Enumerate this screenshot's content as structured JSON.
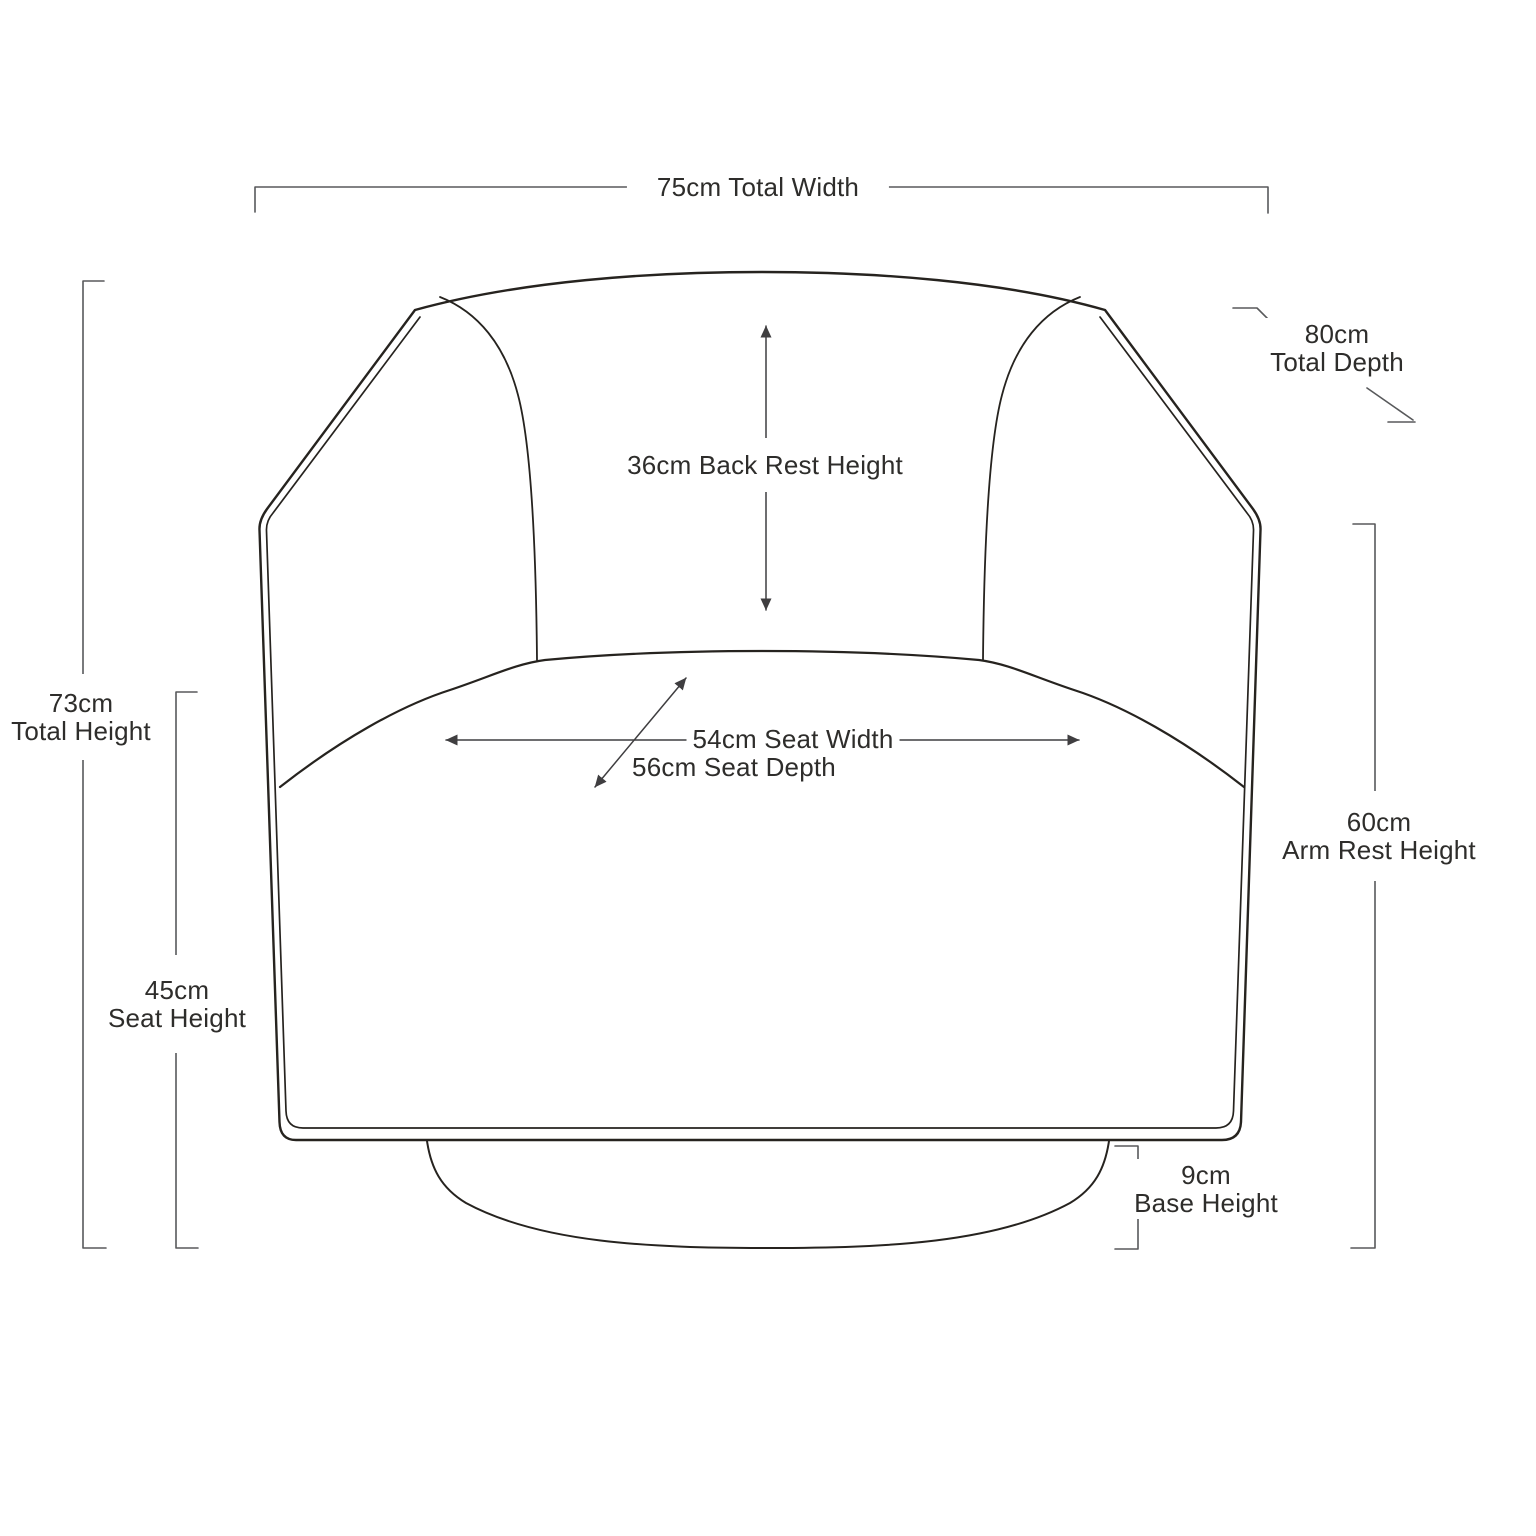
{
  "page": {
    "type": "product-dimension-diagram",
    "subject": "swivel armchair, front elevation line drawing",
    "background": "#ffffff"
  },
  "colors": {
    "chair_outline": "#26231f",
    "dimension_line": "#58595b",
    "arrow_line": "#3f3e40",
    "label_text": "#2e2d2b"
  },
  "dimensions": {
    "total_width": {
      "value": "75cm",
      "label": "Total Width",
      "text": "75cm Total Width"
    },
    "total_depth": {
      "value": "80cm",
      "label": "Total Depth"
    },
    "back_rest_height": {
      "value": "36cm",
      "label": "Back Rest Height",
      "text": "36cm Back Rest Height"
    },
    "total_height": {
      "value": "73cm",
      "label": "Total Height"
    },
    "seat_width": {
      "value": "54cm",
      "label": "Seat Width",
      "text": "54cm Seat Width"
    },
    "seat_depth": {
      "value": "56cm",
      "label": "Seat Depth",
      "text": "56cm Seat Depth"
    },
    "seat_height": {
      "value": "45cm",
      "label": "Seat Height"
    },
    "arm_rest_height": {
      "value": "60cm",
      "label": "Arm Rest Height"
    },
    "base_height": {
      "value": "9cm",
      "label": "Base Height"
    }
  }
}
